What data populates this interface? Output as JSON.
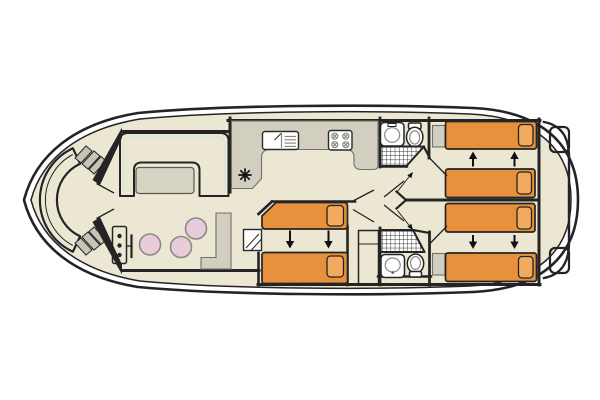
{
  "meta": {
    "type": "boat-deck-plan",
    "subject": "houseboat floor plan, top view",
    "bow_side": "left",
    "stern_side": "right"
  },
  "colors": {
    "background": "#ffffff",
    "outline": "#242424",
    "gunwale": "#ffffff",
    "deck": "#ebe7d2",
    "sofa": "#8ed1b8",
    "sofa_seam": "#cdeadd",
    "table": "#d7d3c4",
    "counter": "#d3cfc0",
    "furniture_edge": "#71716a",
    "bed": "#e8913d",
    "pillow": "#f2aa5e",
    "stool": "#e8ccd9",
    "stool_edge": "#8a8a84",
    "steps": "#c9c5b6",
    "fixture": "#ffffff",
    "arrow": "#111111"
  },
  "areas": {
    "bow_cockpit": {
      "fixtures": [
        "curved-bench",
        "port-steps",
        "starboard-steps",
        "entry-door"
      ]
    },
    "helm_station": {
      "fixtures": [
        "console",
        "steering-wheel"
      ],
      "stool_count": 3
    },
    "saloon": {
      "fixtures": [
        "u-shaped-sofa",
        "dining-table"
      ]
    },
    "galley": {
      "fixtures": [
        "l-shaped-counter",
        "sink-with-drainer",
        "hob-4-burner",
        "heater-symbol"
      ]
    },
    "bathroom_forward": {
      "fixtures": [
        "washbasin",
        "toilet",
        "shower"
      ]
    },
    "cabin_midship": {
      "bed_count": 2,
      "slide_arrows": "down"
    },
    "bathroom_aft": {
      "fixtures": [
        "washbasin",
        "toilet",
        "shower"
      ]
    },
    "cabin_aft_port": {
      "bed_count": 2,
      "slide_arrows": "up"
    },
    "cabin_aft_starboard": {
      "bed_count": 2,
      "slide_arrows": "down"
    },
    "stern_deck": {
      "fixtures": [
        "transom-platform",
        "stern-locker",
        "stern-locker"
      ]
    }
  },
  "totals": {
    "berths": 6,
    "stools": 3,
    "bathrooms": 2,
    "slide_arrow_count": 6
  }
}
